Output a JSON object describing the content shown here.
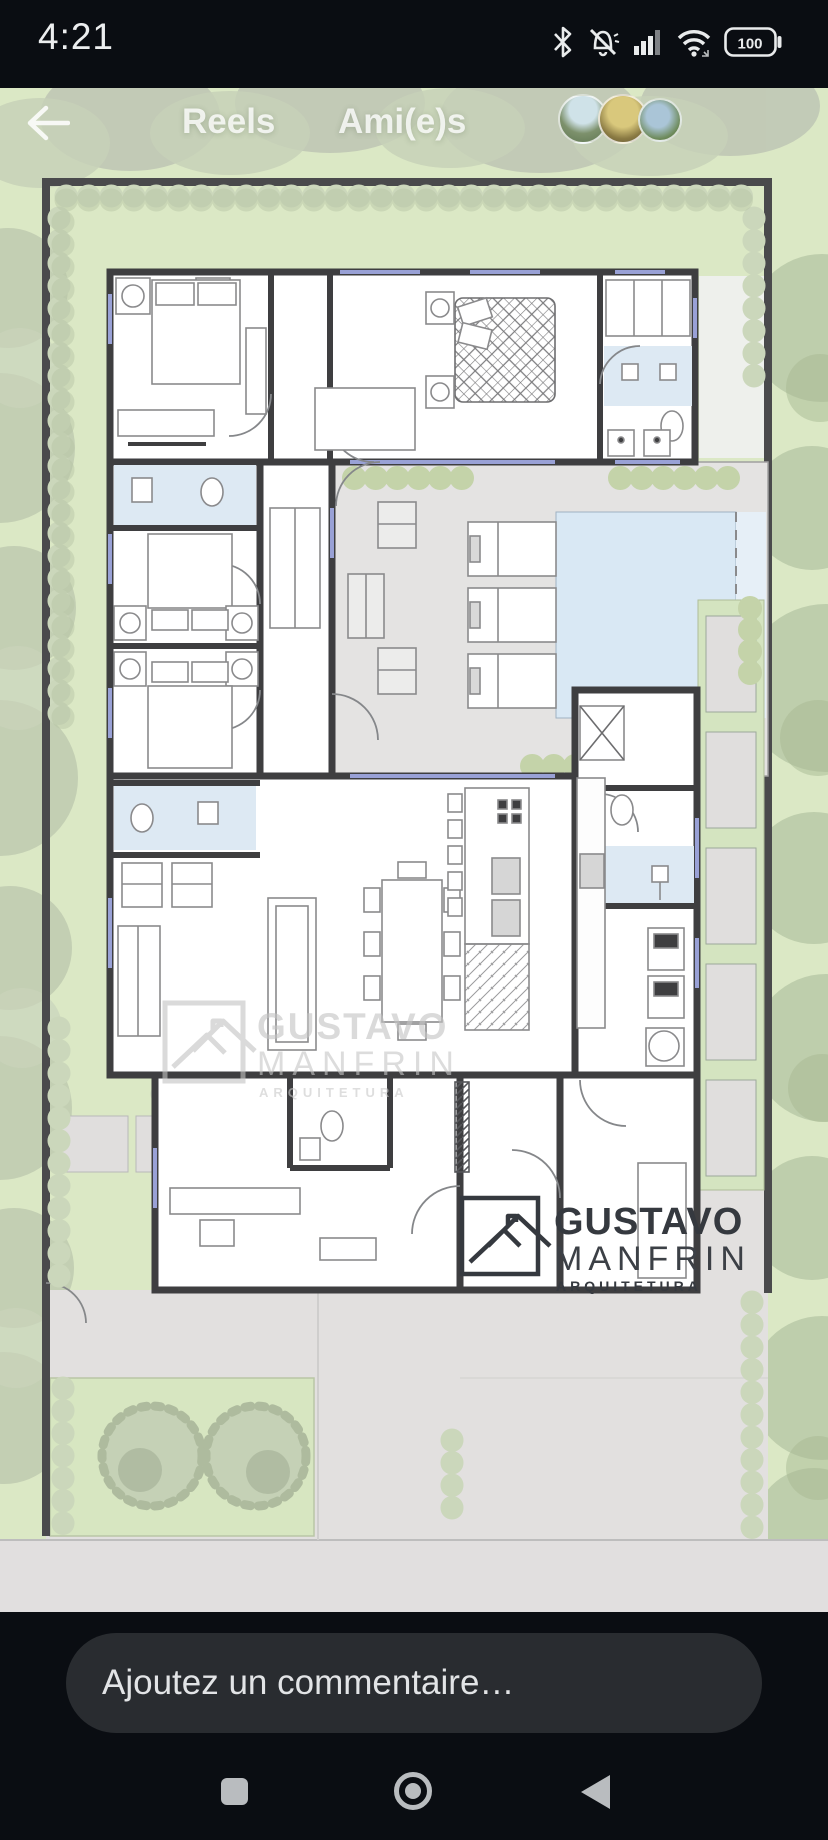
{
  "status_bar": {
    "time": "4:21",
    "battery_level": "100",
    "icons": [
      "bluetooth",
      "notifications-muted",
      "cell-signal",
      "wifi",
      "battery"
    ]
  },
  "header": {
    "reels_label": "Reels",
    "friends_label": "Ami(e)s",
    "back_icon": "back-arrow",
    "avatar_count": 3
  },
  "floor_plan": {
    "description": "architectural site plan of a single-storey house with pool, deck, garden hedges and driveway",
    "watermark": {
      "name_top": "GUSTAVO",
      "name_bottom": "MANFRIN",
      "subtitle": "ARQUITETURA"
    },
    "logo": {
      "name_top": "GUSTAVO",
      "name_bottom": "MANFRIN",
      "subtitle": "ARQUITETURA"
    }
  },
  "comment_bar": {
    "placeholder": "Ajoutez un commentaire…"
  },
  "nav_bar": {
    "buttons": [
      "recents",
      "home",
      "back"
    ]
  },
  "colors": {
    "background": "#0a0d12",
    "surface_pill": "#292c30",
    "text_primary": "#e9ebec",
    "lawn_green": "#dbe8c5",
    "hedge_green": "#cbd7bb",
    "wall_dark": "#424244",
    "deck_gray": "#e4e3e2",
    "pool_blue": "#d9e8f4",
    "bath_blue": "#dde9f3",
    "paving_gray": "#e1dfde",
    "watermark_gray": "#c6c6c6",
    "logo_charcoal": "#35393f",
    "nav_icon_gray": "#b9bcbf"
  }
}
